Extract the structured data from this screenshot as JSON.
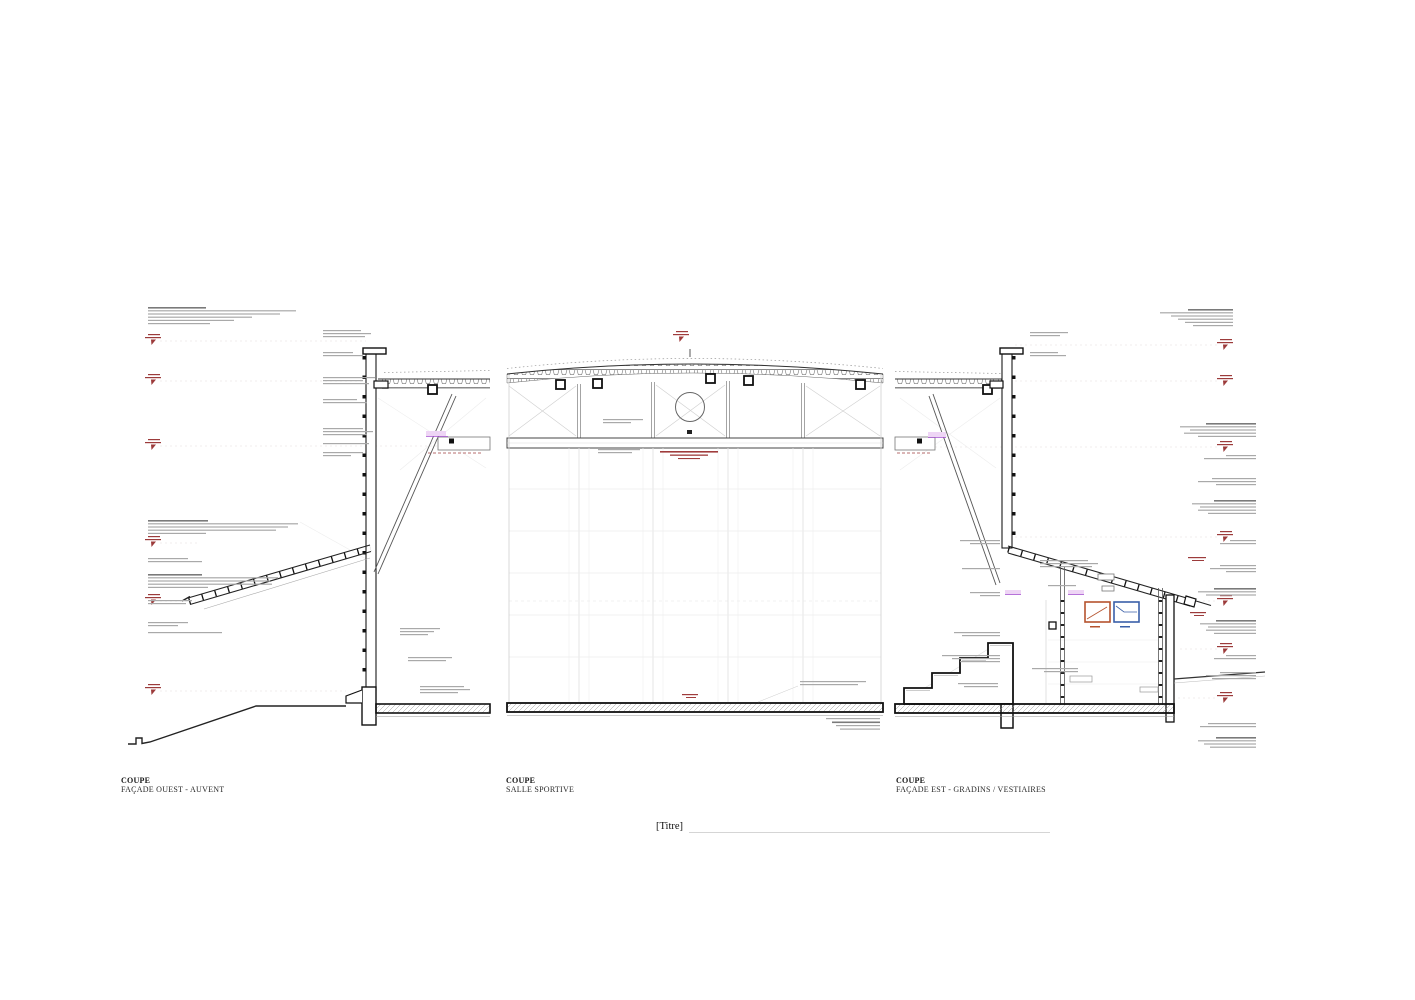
{
  "sheet": {
    "background_color": "#ffffff",
    "title_field": "[Titre]"
  },
  "views": [
    {
      "kind_label": "COUPE",
      "view_name": "FAÇADE OUEST - AUVENT"
    },
    {
      "kind_label": "COUPE",
      "view_name": "SALLE SPORTIVE"
    },
    {
      "kind_label": "COUPE",
      "view_name": "FAÇADE EST - GRADINS / VESTIAIRES"
    }
  ],
  "colors": {
    "section_line": "#1a1a1a",
    "annotation_gray": "#a9a9a9",
    "level_marker_red": "#9c3b3b",
    "selection_purple": "#a44fd0",
    "detail_callout_orange": "#b5532e",
    "detail_callout_blue": "#3a5fa8"
  }
}
